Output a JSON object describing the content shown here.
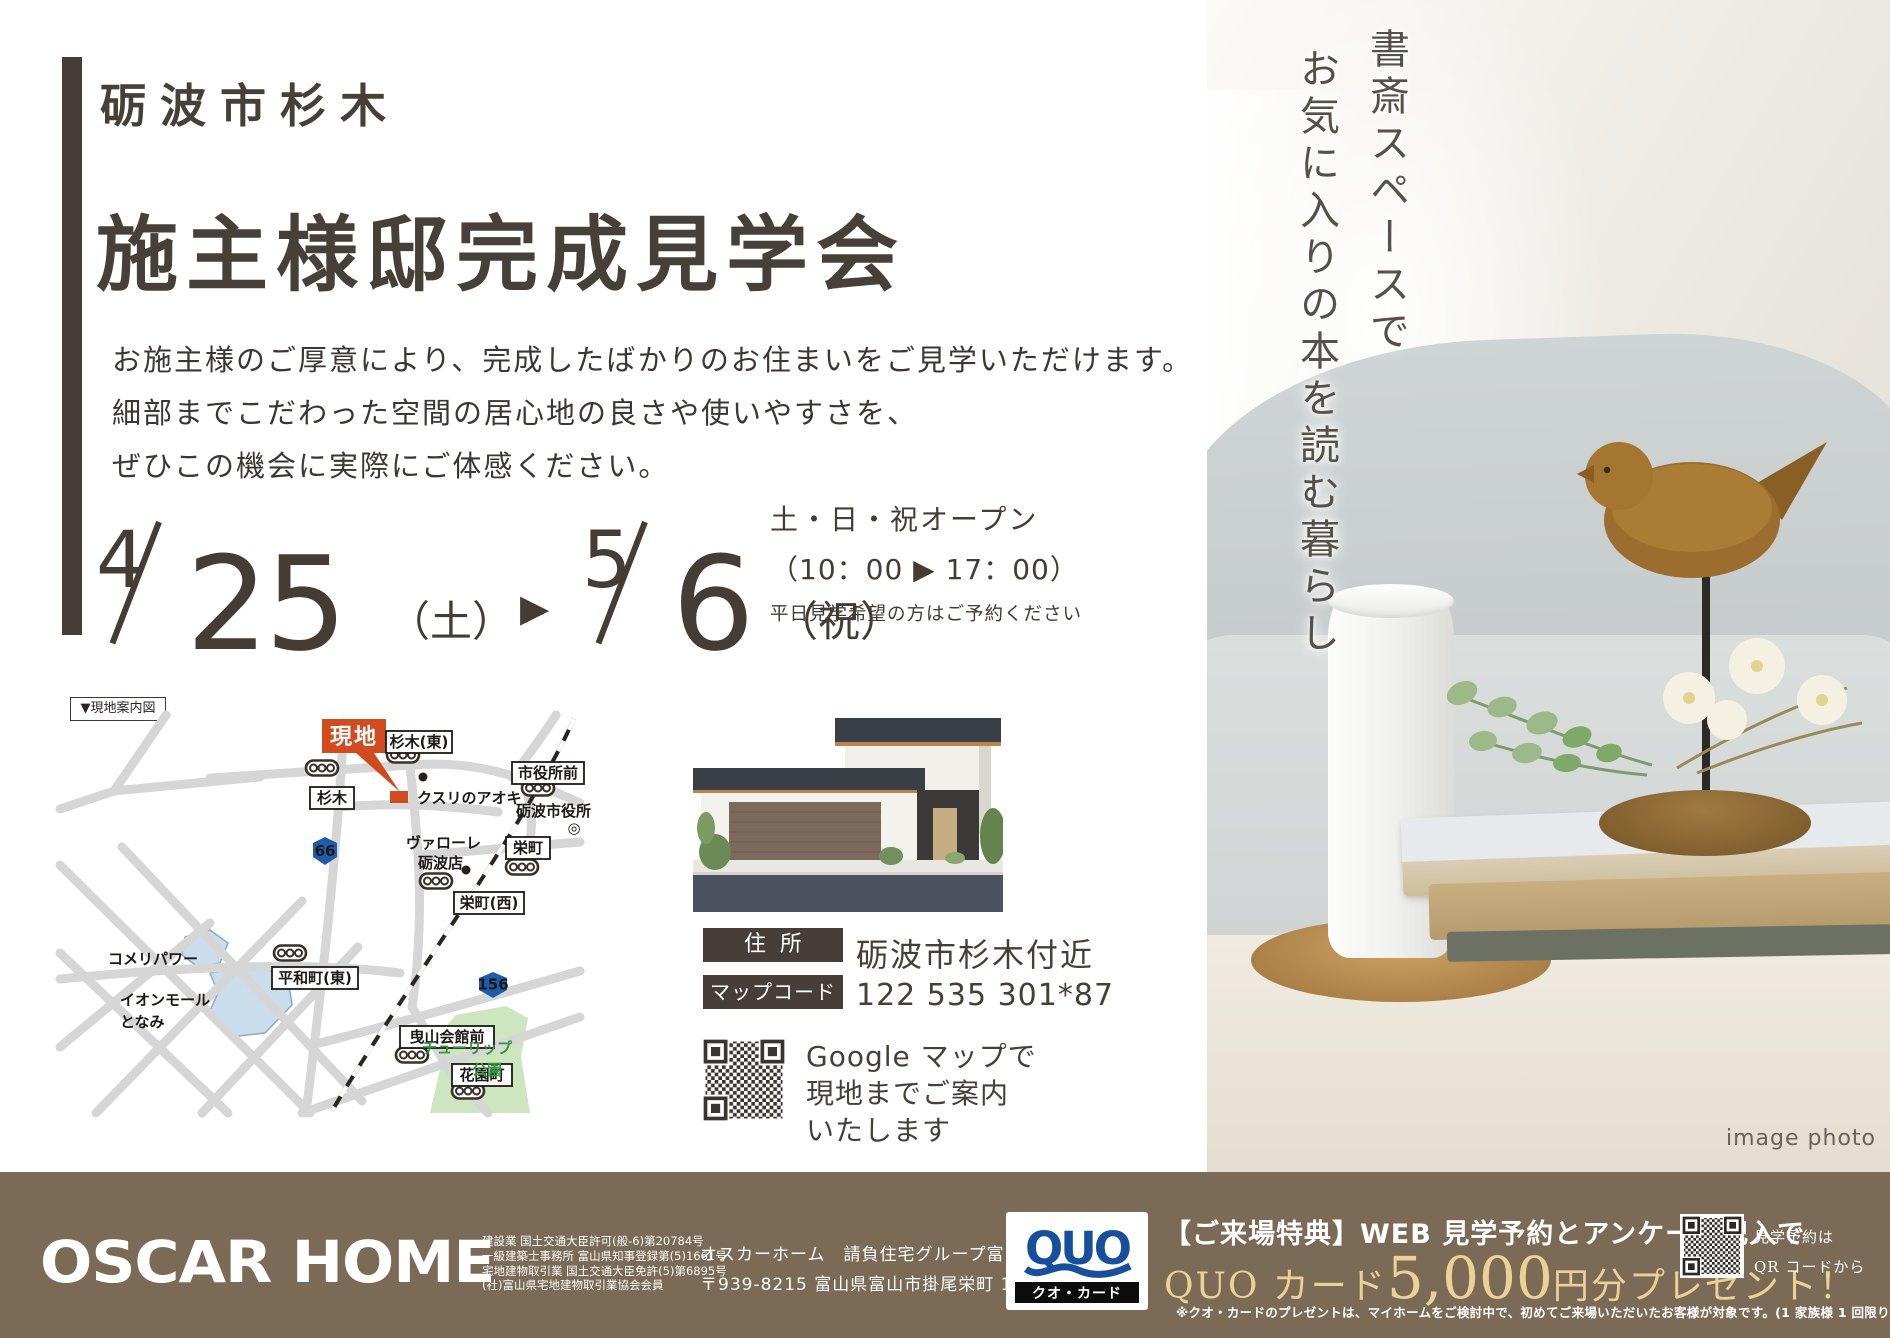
{
  "header": {
    "location": "砺波市杉木",
    "title": "施主様邸完成見学会",
    "intro": [
      "お施主様のご厚意により、完成したばかりのお住まいをご見学いただけます。",
      "細部までこだわった空間の居心地の良さや使いやすさを、",
      "ぜひこの機会に実際にご体感ください。"
    ],
    "date": {
      "m1": "4",
      "d1": "25",
      "w1": "（土）",
      "arrow": "▶",
      "m2": "5",
      "d2": "6",
      "w2": "（祝）"
    },
    "hours": {
      "days": "土・日・祝オープン",
      "time": "（10：00 ▶ 17：00）",
      "note": "平日見学希望の方はご予約ください"
    }
  },
  "map": {
    "caption": "▼現地案内図",
    "site": "現地",
    "stations": [
      "杉木(東)",
      "杉木",
      "市役所前",
      "栄町",
      "栄町(西)",
      "平和町(東)",
      "曳山会館前",
      "花園町"
    ],
    "poi": {
      "kusuri": "クスリのアオキ",
      "cityhall": "砺波市役所",
      "cityhall_mark": "◎",
      "valore1": "ヴァローレ",
      "valore2": "砺波店",
      "komeri": "コメリパワー",
      "aeon1": "イオンモール",
      "aeon2": "となみ",
      "tulip1": "チューリップ",
      "tulip2": "公園"
    },
    "routes": {
      "r66": "66",
      "r156": "156"
    }
  },
  "info": {
    "address_label": "住所",
    "address": "砺波市杉木付近",
    "mapcode_label": "マップコード",
    "mapcode": "122 535 301*87",
    "qr_lines": [
      "Google マップで",
      "現地までご案内",
      "いたします"
    ]
  },
  "photo": {
    "vtext_right": "書斎スペースで",
    "vtext_left": "お気に入りの本を読む暮らし",
    "caption": "image photo"
  },
  "footer": {
    "logo": "OSCAR HOME",
    "licenses": [
      "建設業 国土交通大臣許可(般-6)第20784号",
      "一級建築士事務所 富山県知事登録第(5)1661号",
      "宅地建物取引業 国土交通大臣免許(5)第6895号",
      "(社)富山県宅地建物取引業協会会員"
    ],
    "company": "オスカーホーム　請負住宅グループ富山エリア",
    "address": "〒939-8215 富山県富山市掛尾栄町 1-1",
    "quo": {
      "name": "QUO",
      "sub": "クオ・カード"
    },
    "promo": {
      "line1": "【ご来場特典】WEB 見学予約とアンケート記入で",
      "gold_pre": "QUO カード",
      "gold_big": "5,000",
      "gold_post": "円分プレゼント！",
      "note": "※クオ・カードのプレゼントは、マイホームをご検討中で、初めてご来場いただいたお客様が対象です。(1 家族様 1 回限り)"
    },
    "qr_note1": "見学予約は",
    "qr_note2": "QR コードから"
  },
  "colors": {
    "accent_red": "#d04b1e",
    "footer_brown": "#7b6b56",
    "route_blue": "#1d5cab",
    "gold": "#ecd196",
    "title_dark": "#474039",
    "park_green": "#cde6bf",
    "road_gray": "#d6d6d6"
  }
}
